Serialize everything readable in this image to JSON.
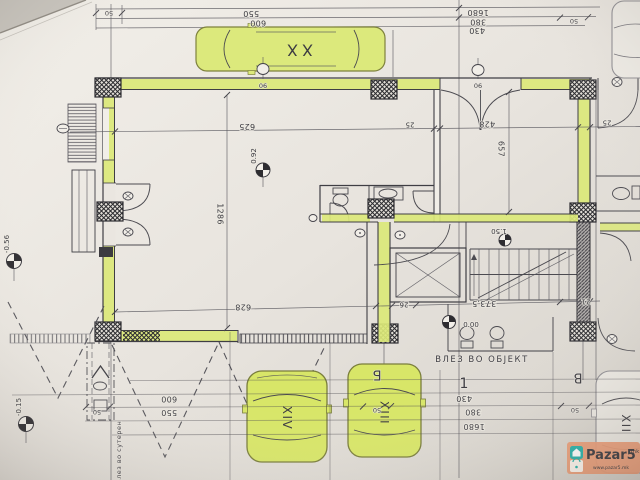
{
  "watermark": {
    "brand": "Pazar5",
    "tld": ".mk",
    "url": "www.pazar5.mk"
  },
  "cars": {
    "top": "XX",
    "left": "XIV",
    "middle": "XIII",
    "right": "XII"
  },
  "grid": {
    "b": "Б",
    "v": "В",
    "one": "1"
  },
  "labels": {
    "entrance": "ВЛЕЗ ВО ОБЈЕКТ",
    "basement_entry": "влез во сутерен"
  },
  "levels": {
    "street": "-0.56",
    "yard": "-0.15",
    "garage": "0.92",
    "ground": "0.00",
    "stair": "1.50"
  },
  "door_tags": {
    "left": "90",
    "entrance": "90"
  },
  "dims": {
    "top": {
      "d50_left": "50",
      "d550": "550",
      "d600": "600",
      "d1680": "1680",
      "d380": "380",
      "d430": "430",
      "d50_right": "50"
    },
    "bottom": {
      "d600": "600",
      "d550": "550",
      "d50_left": "50",
      "d50_mid": "50",
      "d430": "430",
      "d380": "380",
      "d1680": "1680",
      "d50_right": "50"
    },
    "interior": {
      "d625": "625",
      "d25_a": "25",
      "d428": "428",
      "d25_b": "25",
      "d1286": "1286",
      "d657": "657",
      "d628": "628",
      "d26": "26",
      "d373": "373,5",
      "d21": "21"
    }
  },
  "colors": {
    "highlight": "#dbe878",
    "car_highlight": "#d8e668",
    "paper": "#e9e5df",
    "watermark_bg": "#ec9d78",
    "watermark_teal": "#2ab3ab"
  }
}
